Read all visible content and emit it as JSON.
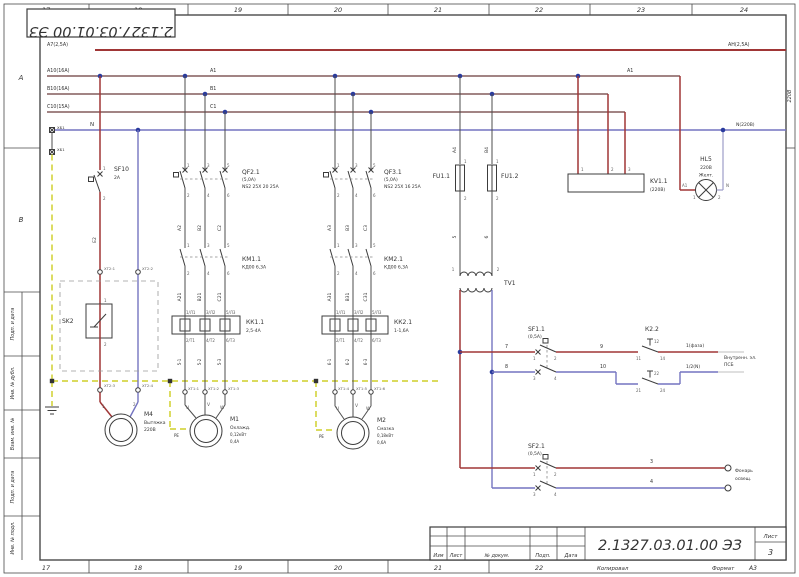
{
  "frame": {
    "top_zones": [
      "17",
      "18",
      "19",
      "20",
      "21",
      "22",
      "23",
      "24"
    ],
    "bottom_zones": [
      "17",
      "18",
      "19",
      "20",
      "21",
      "22"
    ],
    "left_zone_letters": [
      "А",
      "В"
    ],
    "side_fields": [
      "Подп. и дата",
      "Инв. № дубл.",
      "Взам. инв. №",
      "Подп. и дата",
      "Инв. № подл."
    ],
    "top_stamp": "2.1327.03.01.00 ЭЗ"
  },
  "title_block": {
    "doc_number": "2.1327.03.01.00 ЭЗ",
    "cols": [
      "Изм",
      "Лист",
      "№ докум.",
      "Подп.",
      "Дата"
    ],
    "sheet_label": "Лист",
    "sheet_value": "3",
    "copied": "Копировал",
    "format_label": "Формат",
    "format_value": "А3"
  },
  "buses": {
    "top_left": "А7(2,5А)",
    "top_right": "АН(2,5А)",
    "a_label": "А10(16А)",
    "a_tag": "А1",
    "a_tag_right": "А1",
    "b_label": "В10(16А)",
    "b_tag": "В1",
    "c_label": "С10(15А)",
    "c_tag": "С1",
    "n_tag": "N",
    "n_right": "N(220В)",
    "side_220": "220В"
  },
  "entry": {
    "t1": "ХБ1",
    "t2": "ХБ1"
  },
  "fan": {
    "sf": "SF10",
    "sf_sub": "2А",
    "pins": [
      "1",
      "2"
    ],
    "wire": "Е2",
    "term_top": [
      "ХТ2:1",
      "ХТ2:2"
    ],
    "sk": "SK2",
    "sk_pins": [
      "1",
      "2"
    ],
    "term_bot": [
      "ХТ2:3",
      "ХТ2:4"
    ],
    "motor": "М4",
    "motor_sub1": "Вытяжка",
    "motor_sub2": "220В",
    "motor_pins": [
      "1",
      "2"
    ]
  },
  "m1": {
    "qf": "QF2.1",
    "qf_sub1": "(5,0А)",
    "qf_sub2": "NS2 25Х 20 25А",
    "qf_pins_top": [
      "1",
      "3",
      "5"
    ],
    "qf_pins_bot": [
      "2",
      "4",
      "6"
    ],
    "wires_top": [
      "А2",
      "В2",
      "С2"
    ],
    "km": "КМ1.1",
    "km_sub": "КД00 6,3А",
    "km_pins_top": [
      "1",
      "3",
      "5"
    ],
    "km_pins_bot": [
      "2",
      "4",
      "6"
    ],
    "wires_mid": [
      "А21",
      "В21",
      "С21"
    ],
    "kk": "КК1.1",
    "kk_sub": "2,5-4А",
    "kk_pins_top": [
      "1/Л1",
      "3/Л2",
      "5/Л3"
    ],
    "kk_pins_bot": [
      "2/Т1",
      "4/Т2",
      "6/Т3"
    ],
    "cable": [
      "5-1",
      "5-2",
      "5-3"
    ],
    "terms": [
      "ХТ1:1",
      "ХТ1:2",
      "ХТ1:3"
    ],
    "motor_pins": [
      "U",
      "V",
      "W"
    ],
    "pe": "PE",
    "motor": "М1",
    "motor_sub1": "Охлажд.",
    "motor_sub2": "0,12кВт",
    "motor_sub3": "0,4А"
  },
  "m2": {
    "qf": "QF3.1",
    "qf_sub1": "(5,0А)",
    "qf_sub2": "NS2 25Х 16 25А",
    "qf_pins_top": [
      "1",
      "3",
      "5"
    ],
    "qf_pins_bot": [
      "2",
      "4",
      "6"
    ],
    "wires_top": [
      "А3",
      "В3",
      "С3"
    ],
    "km": "КМ2.1",
    "km_sub": "КД00 6,3А",
    "km_pins_top": [
      "1",
      "3",
      "5"
    ],
    "km_pins_bot": [
      "2",
      "4",
      "6"
    ],
    "wires_mid": [
      "А31",
      "В31",
      "С31"
    ],
    "kk": "КК2.1",
    "kk_sub": "1-1,6А",
    "kk_pins_top": [
      "1/Л1",
      "3/Л2",
      "5/Л3"
    ],
    "kk_pins_bot": [
      "2/Т1",
      "4/Т2",
      "6/Т3"
    ],
    "cable": [
      "6-1",
      "6-2",
      "6-3"
    ],
    "terms": [
      "ХТ1:4",
      "ХТ1:5",
      "ХТ1:6"
    ],
    "motor_pins": [
      "U",
      "V",
      "W"
    ],
    "pe": "PE",
    "motor": "М2",
    "motor_sub1": "Смазка",
    "motor_sub2": "0,18кВт",
    "motor_sub3": "0,6А"
  },
  "control": {
    "fu1": "FU1.1",
    "fu2": "FU1.2",
    "fu1_pins": [
      "1",
      "2"
    ],
    "fu2_pins": [
      "1",
      "2"
    ],
    "fu_wires_top": [
      "А4",
      "В4"
    ],
    "fu_wires_bot": [
      "5",
      "6"
    ],
    "tv": "ТV1",
    "tv_pins": [
      "1",
      "2"
    ],
    "sf11": "SF1.1",
    "sf11_sub": "(0,5А)",
    "sf11_pins": [
      "1",
      "2",
      "3",
      "4"
    ],
    "wire7": "7",
    "wire8": "8",
    "wire9": "9",
    "wire10": "10",
    "k22": "К2.2",
    "k22_pins_top": [
      "11",
      "12",
      "14"
    ],
    "k22_pins_bot": [
      "21",
      "22",
      "24"
    ],
    "out1": "1(фаза)",
    "out2": "1/2(N)",
    "note1": "Внутренн. эл.",
    "note2": "ПСБ",
    "sf21": "SF2.1",
    "sf21_sub": "(0,5А)",
    "sf21_pins": [
      "1",
      "2",
      "3",
      "4"
    ],
    "wire3": "3",
    "wire4": "4",
    "note3": "Фонарь",
    "note4": "освещ."
  },
  "kv": {
    "ref": "KV1.1",
    "sub": "(220В)",
    "pins": [
      "1",
      "2",
      "3"
    ]
  },
  "hl": {
    "ref": "HL5",
    "sub1": "220В",
    "sub2": "Желт.",
    "tag_a": "А1",
    "tag_n": "N",
    "pins": [
      "1",
      "2"
    ]
  },
  "colors": {
    "phase_red": "#a03636",
    "bus_dark": "#6a3a3a",
    "neutral_blue": "#7474c0",
    "pe_yellow": "#d6d648",
    "frame": "#4a4a4a"
  }
}
